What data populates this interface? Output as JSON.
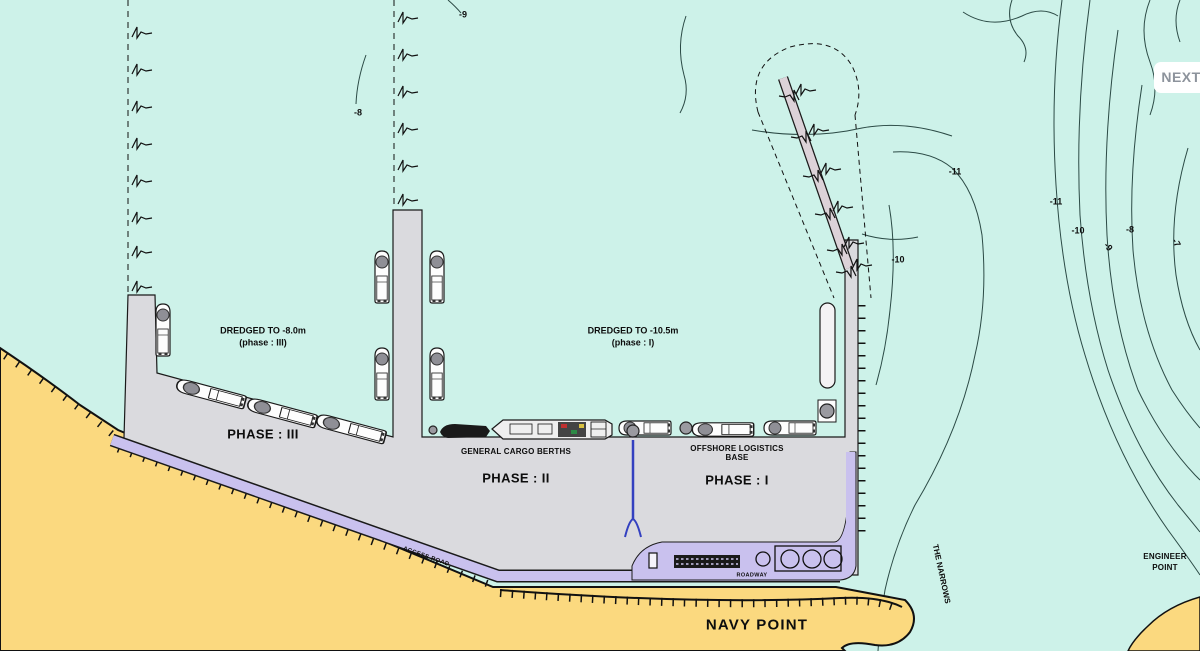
{
  "ui": {
    "next_button": "NEXT"
  },
  "map": {
    "annotations": {
      "dredged_phase3_line1": "DREDGED TO -8.0m",
      "dredged_phase3_line2": "(phase :  III)",
      "dredged_phase1_line1": "DREDGED TO -10.5m",
      "dredged_phase1_line2": "(phase : I)",
      "phase3": "PHASE : III",
      "phase2": "PHASE : II",
      "phase1": "PHASE : I",
      "general_cargo": "GENERAL CARGO BERTHS",
      "offshore_logistics_line1": "OFFSHORE LOGISTICS",
      "offshore_logistics_line2": "BASE",
      "navy_point": "NAVY POINT",
      "engineer_point_line1": "ENGINEER",
      "engineer_point_line2": "POINT",
      "the_narrows": "THE NARROWS",
      "access_road": "ACCESS ROAD",
      "roadway": "ROADWAY"
    },
    "depth_labels": [
      {
        "text": "-9"
      },
      {
        "text": "-8"
      },
      {
        "text": "-11"
      },
      {
        "text": "-10"
      },
      {
        "text": "-11"
      },
      {
        "text": "-10"
      },
      {
        "text": "-9"
      },
      {
        "text": "-8"
      },
      {
        "text": "-7"
      }
    ],
    "colors": {
      "water": "#cdf2e9",
      "land": "#fbd97f",
      "reclaim": "#dadade",
      "road": "#c9c1ee",
      "trestle": "#dcd2d8",
      "slipway": "#3340c0",
      "contour": "#2b4a45"
    }
  }
}
